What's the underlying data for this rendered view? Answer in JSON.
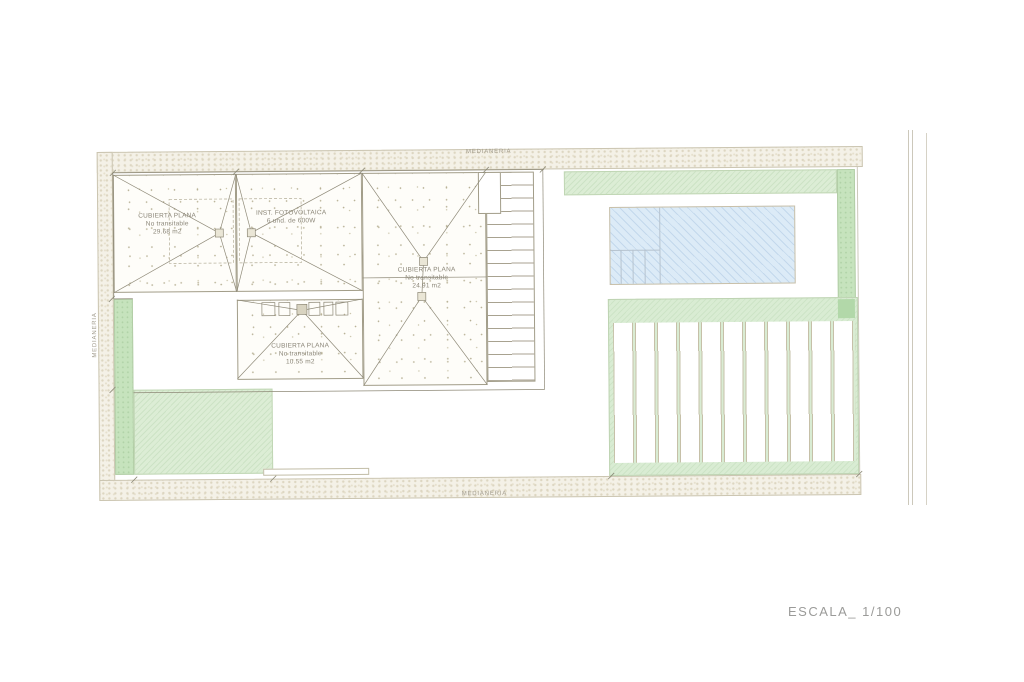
{
  "plan": {
    "boundary_labels": {
      "top": "MEDIANERIA",
      "left": "MEDIANERIA",
      "bottom": "MEDIANERIA"
    },
    "roof_labels": [
      {
        "line1": "CUBIERTA PLANA",
        "line2": "No transitable",
        "line3": "29.68 m2"
      },
      {
        "line1": "INST. FOTOVOLTAICA",
        "line2": "6 und. de 600W",
        "line3": ""
      },
      {
        "line1": "CUBIERTA PLANA",
        "line2": "No transitable",
        "line3": "24.91 m2"
      },
      {
        "line1": "CUBIERTA PLANA",
        "line2": "No transitable",
        "line3": "10.55 m2"
      }
    ],
    "scale_label": "ESCALA_ 1/100",
    "pergola_slat_count": 11,
    "colors": {
      "boundary_hatch": "#f4f1e7",
      "boundary_dot": "#ddd6c1",
      "roof_line": "#8e8977",
      "lawn_light": "#dcedd5",
      "lawn_dark": "#c6e3bd",
      "pool_blue": "#dcebf7",
      "annotation_gray": "#a19b8c",
      "scale_text_gray": "#9b9b99"
    }
  }
}
